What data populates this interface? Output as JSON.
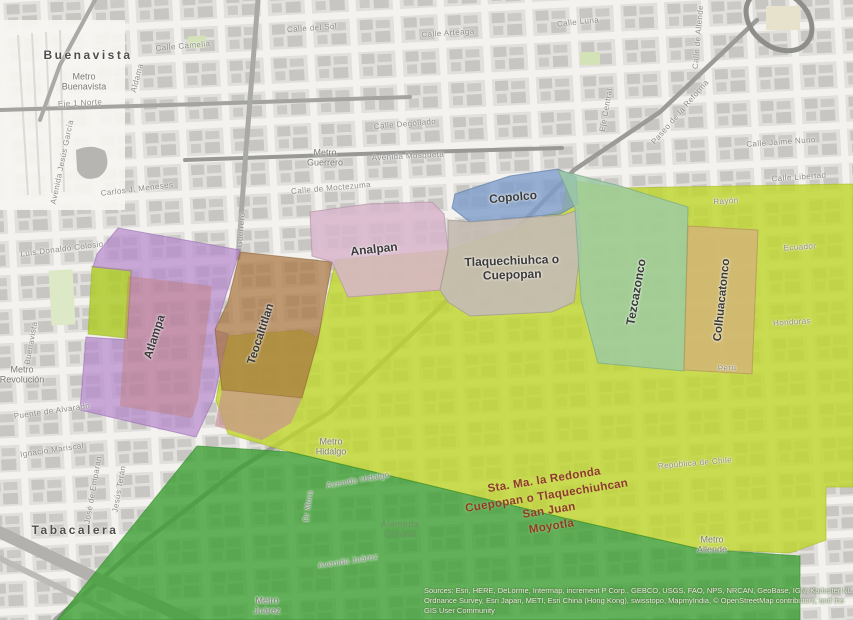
{
  "map": {
    "districts": [
      {
        "name": "Buenavista"
      },
      {
        "name": "Tabacalera"
      }
    ],
    "regions": [
      {
        "name": "Atlampa",
        "color": "#b588cc"
      },
      {
        "name": "Teocaltitlan",
        "color": "#a87440"
      },
      {
        "name": "Analpan",
        "color": "#d7b5ca"
      },
      {
        "name": "Copolco",
        "color": "#7d9cc9"
      },
      {
        "name": "Tlaquechiuhca o Cuepopan",
        "color": "#c4bcb2"
      },
      {
        "name": "Tezcazonco",
        "color": "#9ccaa6"
      },
      {
        "name": "Colhuacatonco",
        "color": "#d2b577"
      }
    ],
    "overlay_label": {
      "text": "Sta. Ma. la Redonda\nCuepopan o Tlaquechiuhcan\nSan Juan\nMoyotla",
      "color": "#8e3a30"
    },
    "area_colors": {
      "yellow_green": "#c0d62e",
      "dark_green": "#3da035",
      "lime_patch": "#aecb2a"
    },
    "metro_stations": [
      {
        "label": "Metro\nBuenavista"
      },
      {
        "label": "Metro\nGuerrero"
      },
      {
        "label": "Metro\nHidalgo"
      },
      {
        "label": "Metro\nRevolución"
      },
      {
        "label": "Metro\nAllende"
      },
      {
        "label": "Metro\nJuárez"
      }
    ],
    "streets": [
      {
        "name": "Calle Camelia"
      },
      {
        "name": "Calle del Sol"
      },
      {
        "name": "Calle Arteaga"
      },
      {
        "name": "Calle Luna"
      },
      {
        "name": "Calle Degollado"
      },
      {
        "name": "Avenida Mosqueta"
      },
      {
        "name": "Calle de Moctezuma"
      },
      {
        "name": "Eje 1 Norte"
      },
      {
        "name": "Carlos J. Meneses"
      },
      {
        "name": "Luis Donaldo Colosio"
      },
      {
        "name": "Avenida Jesús García"
      },
      {
        "name": "Aldama"
      },
      {
        "name": "Buenavista"
      },
      {
        "name": "Puente de Alvarado"
      },
      {
        "name": "Ignacio Mariscal"
      },
      {
        "name": "José de Emparan"
      },
      {
        "name": "Jesús Terán"
      },
      {
        "name": "Avenida Hidalgo"
      },
      {
        "name": "Avenida Juárez"
      },
      {
        "name": "Dr Mora"
      },
      {
        "name": "Eje Central"
      },
      {
        "name": "Calle de Allende"
      },
      {
        "name": "Paseo de la Reforma"
      },
      {
        "name": "Calle Jaime Nuno"
      },
      {
        "name": "Calle Libertad"
      },
      {
        "name": "Rayón"
      },
      {
        "name": "Ecuador"
      },
      {
        "name": "Honduras"
      },
      {
        "name": "Perú"
      },
      {
        "name": "República de Chile"
      },
      {
        "name": "Guerrero"
      },
      {
        "name": "Alameda\nCentral"
      }
    ],
    "attribution": "Sources: Esri, HERE, DeLorme, Intermap, increment P Corp., GEBCO, USGS, FAO, NPS, NRCAN, GeoBase, IGN, Kadaster NL, Ordnance Survey, Esri Japan, METI, Esri China (Hong Kong), swisstopo, MapmyIndia, © OpenStreetMap contributors, and the GIS User Community"
  }
}
